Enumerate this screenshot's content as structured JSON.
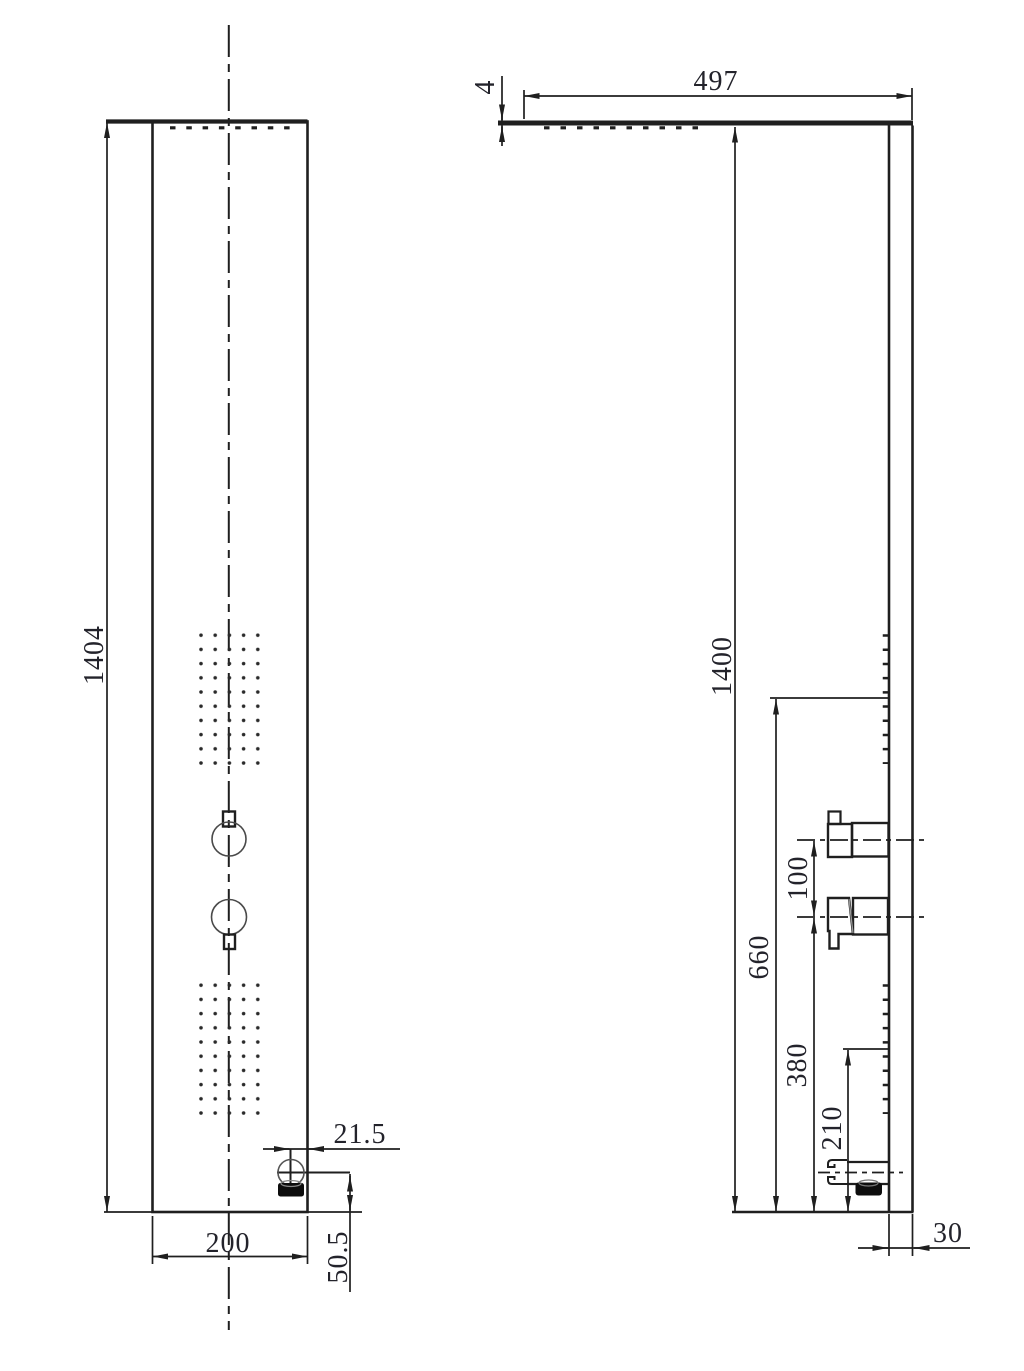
{
  "drawing": {
    "kind": "shower-panel-technical-drawing",
    "colors": {
      "line": "#1f1f1f",
      "thin_line": "#4a4a4a",
      "dim_text": "#23232b",
      "background": "#ffffff",
      "fill_solid": "#0d0d0d"
    },
    "views": {
      "front": {
        "label": "front-view",
        "dims": {
          "height": "1404",
          "width": "200",
          "outlet_offset": "21.5",
          "outlet_height": "50.5"
        }
      },
      "side": {
        "label": "side-view",
        "dims": {
          "head_length": "497",
          "head_thickness": "4",
          "height": "1400",
          "upper_jets_center": "660",
          "handle_spacing": "100",
          "lower_handle_height": "380",
          "lower_jets_center": "210",
          "panel_depth": "30"
        }
      }
    }
  }
}
